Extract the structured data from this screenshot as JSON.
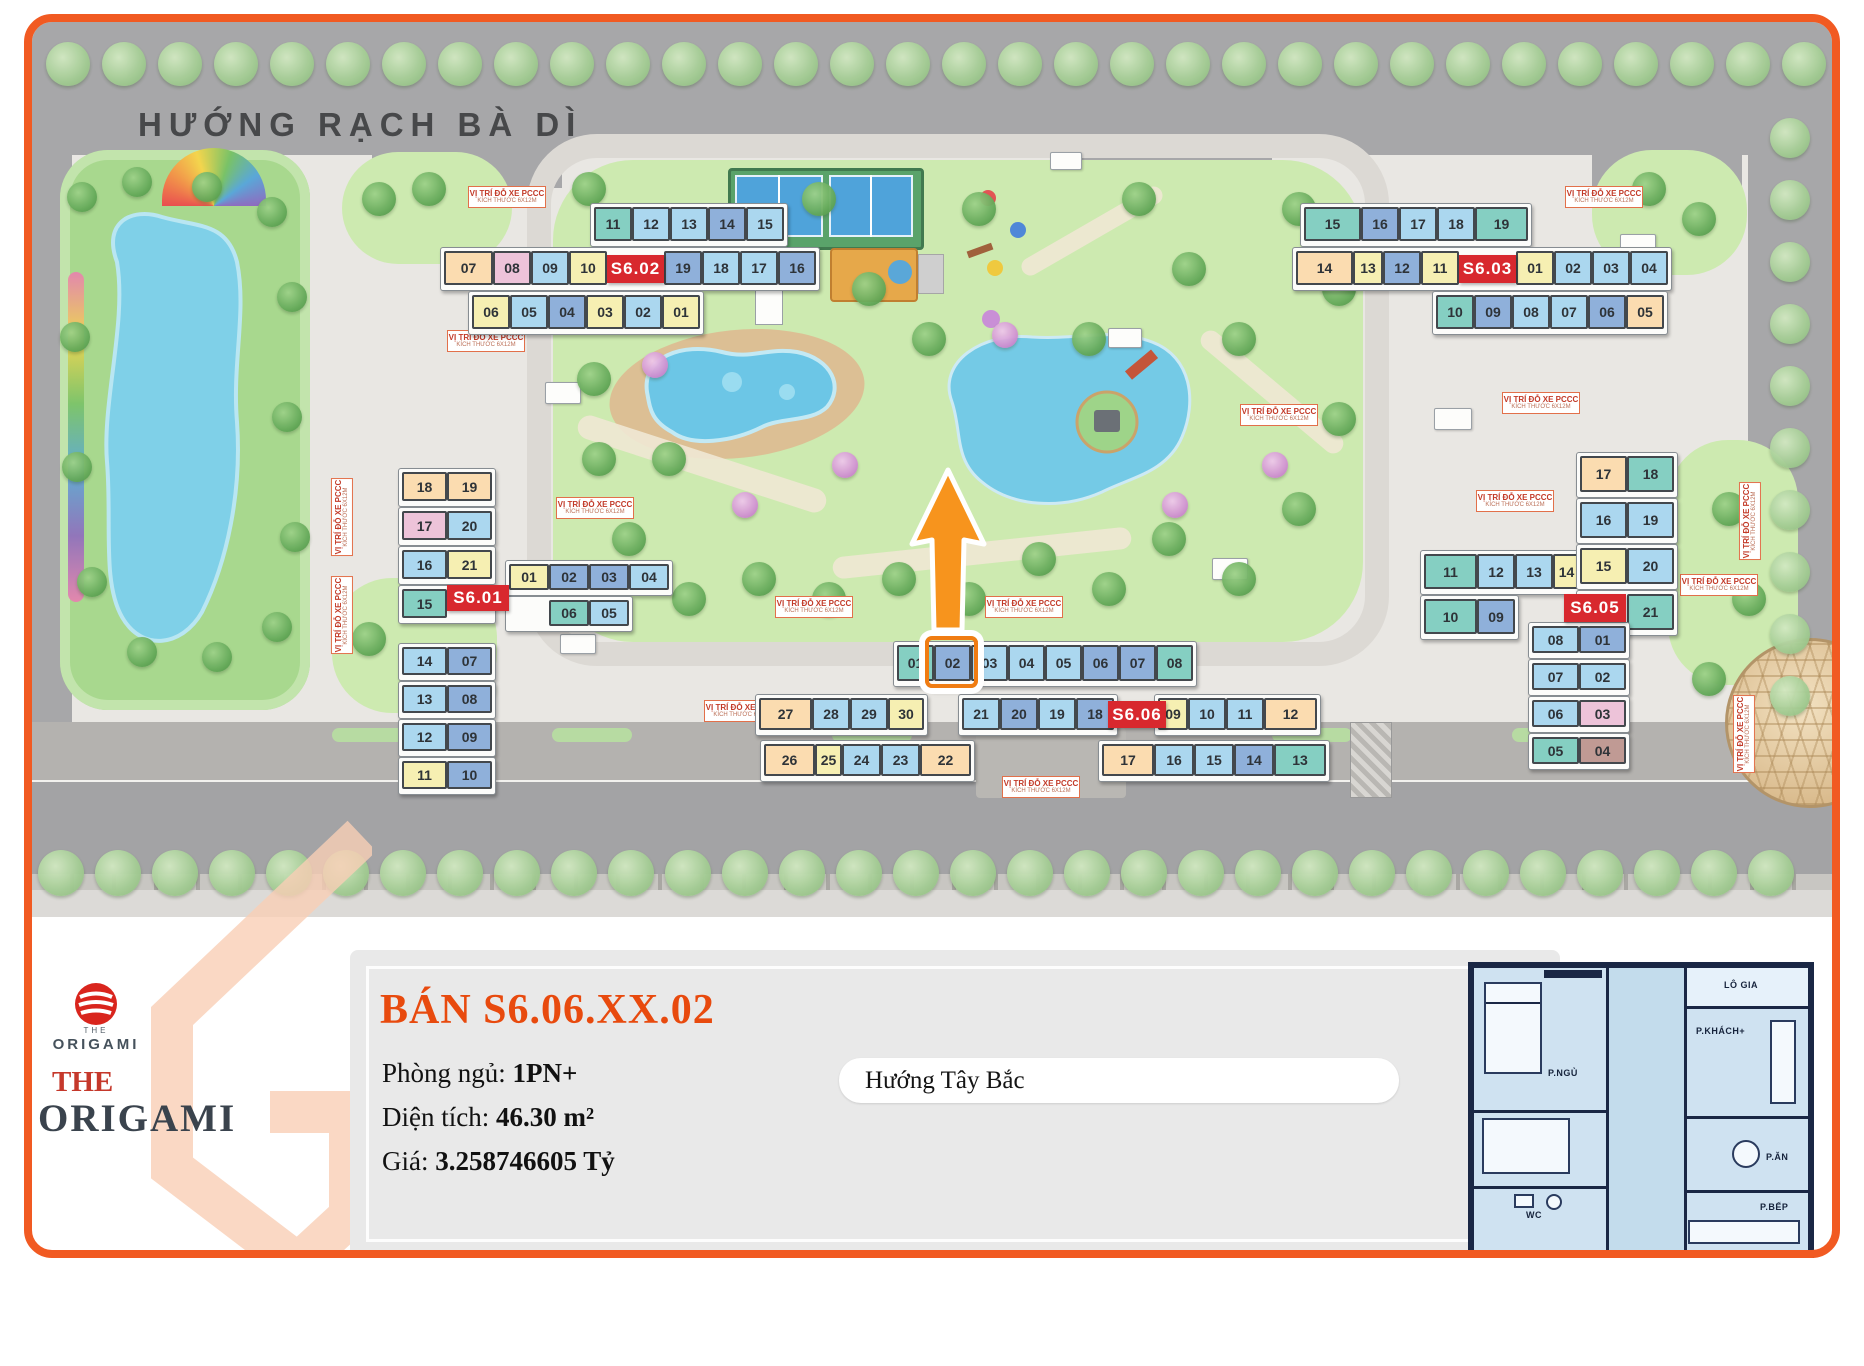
{
  "map": {
    "street_title": "HƯỚNG RẠCH BÀ DÌ",
    "parking_label": {
      "line1": "VỊ TRÍ ĐỖ XE PCCC",
      "line2": "KÍCH THƯỚC 6X12M"
    },
    "palette": {
      "teal": "#85cfc2",
      "lt": "#abd7ef",
      "bl": "#8fb0da",
      "yl": "#f6efb2",
      "cr": "#fbdcb0",
      "pk": "#edc3d9",
      "br": "#c09a94",
      "label_bg": "#d8282e",
      "highlight": "#f07c12",
      "arrow": "#f7941d"
    },
    "highlighted_unit": {
      "building": "S6.06",
      "unit": "02"
    },
    "buildings": [
      {
        "id": "S6.01",
        "label": "S6.01",
        "blocks": [
          {
            "rows": [
              [
                {
                  "n": "18",
                  "c": "cr"
                },
                {
                  "n": "19",
                  "c": "cr"
                }
              ],
              [
                {
                  "n": "17",
                  "c": "pk"
                },
                {
                  "n": "20",
                  "c": "lt"
                }
              ],
              [
                {
                  "n": "16",
                  "c": "lt"
                },
                {
                  "n": "21",
                  "c": "yl"
                }
              ],
              [
                {
                  "n": "15",
                  "c": "teal"
                },
                {
                  "sp": 1
                }
              ]
            ]
          },
          {
            "rows": [
              [
                {
                  "n": "01",
                  "c": "yl"
                },
                {
                  "n": "02",
                  "c": "bl"
                },
                {
                  "n": "03",
                  "c": "bl"
                },
                {
                  "n": "04",
                  "c": "lt"
                }
              ],
              [
                {
                  "sp": 1
                },
                {
                  "n": "06",
                  "c": "teal"
                },
                {
                  "n": "05",
                  "c": "lt"
                }
              ]
            ]
          },
          {
            "rows": [
              [
                {
                  "n": "14",
                  "c": "lt"
                },
                {
                  "n": "07",
                  "c": "bl"
                }
              ],
              [
                {
                  "n": "13",
                  "c": "lt"
                },
                {
                  "n": "08",
                  "c": "bl"
                }
              ],
              [
                {
                  "n": "12",
                  "c": "lt"
                },
                {
                  "n": "09",
                  "c": "bl"
                }
              ],
              [
                {
                  "n": "11",
                  "c": "yl"
                },
                {
                  "n": "10",
                  "c": "bl"
                }
              ]
            ]
          }
        ]
      },
      {
        "id": "S6.02",
        "label": "S6.02",
        "blocks": [
          {
            "rows": [
              [
                {
                  "n": "11",
                  "c": "teal"
                },
                {
                  "n": "12",
                  "c": "lt"
                },
                {
                  "n": "13",
                  "c": "lt"
                },
                {
                  "n": "14",
                  "c": "bl"
                },
                {
                  "n": "15",
                  "c": "lt"
                }
              ],
              [
                {
                  "n": "07",
                  "c": "cr",
                  "w": 1.3
                },
                {
                  "n": "08",
                  "c": "pk"
                },
                {
                  "n": "09",
                  "c": "lt"
                },
                {
                  "n": "10",
                  "c": "yl"
                },
                {
                  "lbl": 1,
                  "w": 1.5
                },
                {
                  "n": "19",
                  "c": "bl"
                },
                {
                  "n": "18",
                  "c": "lt"
                },
                {
                  "n": "17",
                  "c": "lt"
                },
                {
                  "n": "16",
                  "c": "bl"
                }
              ],
              [
                {
                  "n": "06",
                  "c": "yl"
                },
                {
                  "n": "05",
                  "c": "lt"
                },
                {
                  "n": "04",
                  "c": "bl"
                },
                {
                  "n": "03",
                  "c": "yl"
                },
                {
                  "n": "02",
                  "c": "lt"
                },
                {
                  "n": "01",
                  "c": "yl"
                }
              ]
            ]
          }
        ]
      },
      {
        "id": "S6.03",
        "label": "S6.03",
        "blocks": [
          {
            "rows": [
              [
                {
                  "n": "15",
                  "c": "teal",
                  "w": 1.5
                },
                {
                  "n": "16",
                  "c": "bl"
                },
                {
                  "n": "17",
                  "c": "lt"
                },
                {
                  "n": "18",
                  "c": "lt"
                },
                {
                  "n": "19",
                  "c": "teal",
                  "w": 1.4
                }
              ],
              [
                {
                  "n": "14",
                  "c": "cr",
                  "w": 1.5
                },
                {
                  "n": "13",
                  "c": "yl",
                  "w": 0.8
                },
                {
                  "n": "12",
                  "c": "bl"
                },
                {
                  "n": "11",
                  "c": "yl"
                },
                {
                  "lbl": 1,
                  "w": 1.5
                },
                {
                  "n": "01",
                  "c": "yl"
                },
                {
                  "n": "02",
                  "c": "lt"
                },
                {
                  "n": "03",
                  "c": "lt"
                },
                {
                  "n": "04",
                  "c": "lt"
                }
              ],
              [
                {
                  "n": "10",
                  "c": "teal"
                },
                {
                  "n": "09",
                  "c": "bl"
                },
                {
                  "n": "08",
                  "c": "lt"
                },
                {
                  "n": "07",
                  "c": "lt"
                },
                {
                  "n": "06",
                  "c": "bl"
                },
                {
                  "n": "05",
                  "c": "cr"
                }
              ]
            ]
          }
        ]
      },
      {
        "id": "S6.05",
        "label": "S6.05",
        "blocks": [
          {
            "rows": [
              [
                {
                  "n": "11",
                  "c": "teal",
                  "w": 1.4
                },
                {
                  "n": "12",
                  "c": "lt"
                },
                {
                  "n": "13",
                  "c": "lt"
                },
                {
                  "n": "14",
                  "c": "yl",
                  "w": 0.7
                }
              ],
              [
                {
                  "n": "10",
                  "c": "teal",
                  "w": 1.4
                },
                {
                  "n": "09",
                  "c": "bl"
                }
              ]
            ]
          },
          {
            "rows": [
              [
                {
                  "n": "17",
                  "c": "cr"
                },
                {
                  "n": "18",
                  "c": "teal"
                }
              ],
              [
                {
                  "n": "16",
                  "c": "lt"
                },
                {
                  "n": "19",
                  "c": "lt"
                }
              ],
              [
                {
                  "n": "15",
                  "c": "yl"
                },
                {
                  "n": "20",
                  "c": "lt"
                }
              ],
              [
                {
                  "sp": 1
                },
                {
                  "n": "21",
                  "c": "teal"
                }
              ]
            ]
          },
          {
            "rows": [
              [
                {
                  "n": "08",
                  "c": "lt"
                },
                {
                  "n": "01",
                  "c": "bl"
                }
              ],
              [
                {
                  "n": "07",
                  "c": "lt"
                },
                {
                  "n": "02",
                  "c": "lt"
                }
              ],
              [
                {
                  "n": "06",
                  "c": "lt"
                },
                {
                  "n": "03",
                  "c": "pk"
                }
              ],
              [
                {
                  "n": "05",
                  "c": "teal"
                },
                {
                  "n": "04",
                  "c": "br"
                }
              ]
            ]
          }
        ]
      },
      {
        "id": "S6.06",
        "label": "S6.06",
        "blocks": [
          {
            "rows": [
              [
                {
                  "n": "01",
                  "c": "teal"
                },
                {
                  "n": "02",
                  "c": "bl",
                  "hl": 1
                },
                {
                  "n": "03",
                  "c": "lt"
                },
                {
                  "n": "04",
                  "c": "lt"
                },
                {
                  "n": "05",
                  "c": "lt"
                },
                {
                  "n": "06",
                  "c": "bl"
                },
                {
                  "n": "07",
                  "c": "bl"
                },
                {
                  "n": "08",
                  "c": "teal"
                }
              ]
            ]
          },
          {
            "rows": [
              [
                {
                  "n": "27",
                  "c": "cr",
                  "w": 1.4
                },
                {
                  "n": "28",
                  "c": "lt"
                },
                {
                  "n": "29",
                  "c": "lt"
                },
                {
                  "n": "30",
                  "c": "yl",
                  "w": 0.95
                }
              ]
            ]
          },
          {
            "rows": [
              [
                {
                  "n": "21",
                  "c": "lt"
                },
                {
                  "n": "20",
                  "c": "bl"
                },
                {
                  "n": "19",
                  "c": "lt"
                },
                {
                  "n": "18",
                  "c": "bl"
                }
              ]
            ]
          },
          {
            "rows": [
              [
                {
                  "n": "09",
                  "c": "yl",
                  "w": 0.8
                },
                {
                  "n": "10",
                  "c": "lt"
                },
                {
                  "n": "11",
                  "c": "lt"
                },
                {
                  "n": "12",
                  "c": "cr",
                  "w": 1.4
                }
              ]
            ]
          },
          {
            "rows": [
              [
                {
                  "n": "26",
                  "c": "cr",
                  "w": 1.3
                },
                {
                  "n": "25",
                  "c": "yl",
                  "w": 0.7
                },
                {
                  "n": "24",
                  "c": "lt"
                },
                {
                  "n": "23",
                  "c": "lt"
                },
                {
                  "n": "22",
                  "c": "cr",
                  "w": 1.3
                }
              ]
            ]
          },
          {
            "rows": [
              [
                {
                  "n": "17",
                  "c": "cr",
                  "w": 1.3
                },
                {
                  "n": "16",
                  "c": "lt"
                },
                {
                  "n": "15",
                  "c": "lt"
                },
                {
                  "n": "14",
                  "c": "bl"
                },
                {
                  "n": "13",
                  "c": "teal",
                  "w": 1.3
                }
              ]
            ]
          }
        ]
      }
    ]
  },
  "info": {
    "title": "BÁN S6.06.XX.02",
    "fields": [
      {
        "label": "Phòng ngủ: ",
        "value": "1PN+"
      },
      {
        "label": "Diện tích: ",
        "value": "46.30 m²"
      },
      {
        "label": "Giá: ",
        "value": "3.258746605 Tỷ"
      }
    ],
    "direction": "Hướng Tây Bắc"
  },
  "logo": {
    "mini_title": "THE",
    "mini_name": "ORIGAMI",
    "big_the": "THE",
    "big_name": "ORIGAMI"
  },
  "floorplan": {
    "rooms": [
      "P.NGỦ",
      "P.KHÁCH+",
      "P.ĂN",
      "WC",
      "P.BẾP",
      "LÔ GIA"
    ]
  }
}
